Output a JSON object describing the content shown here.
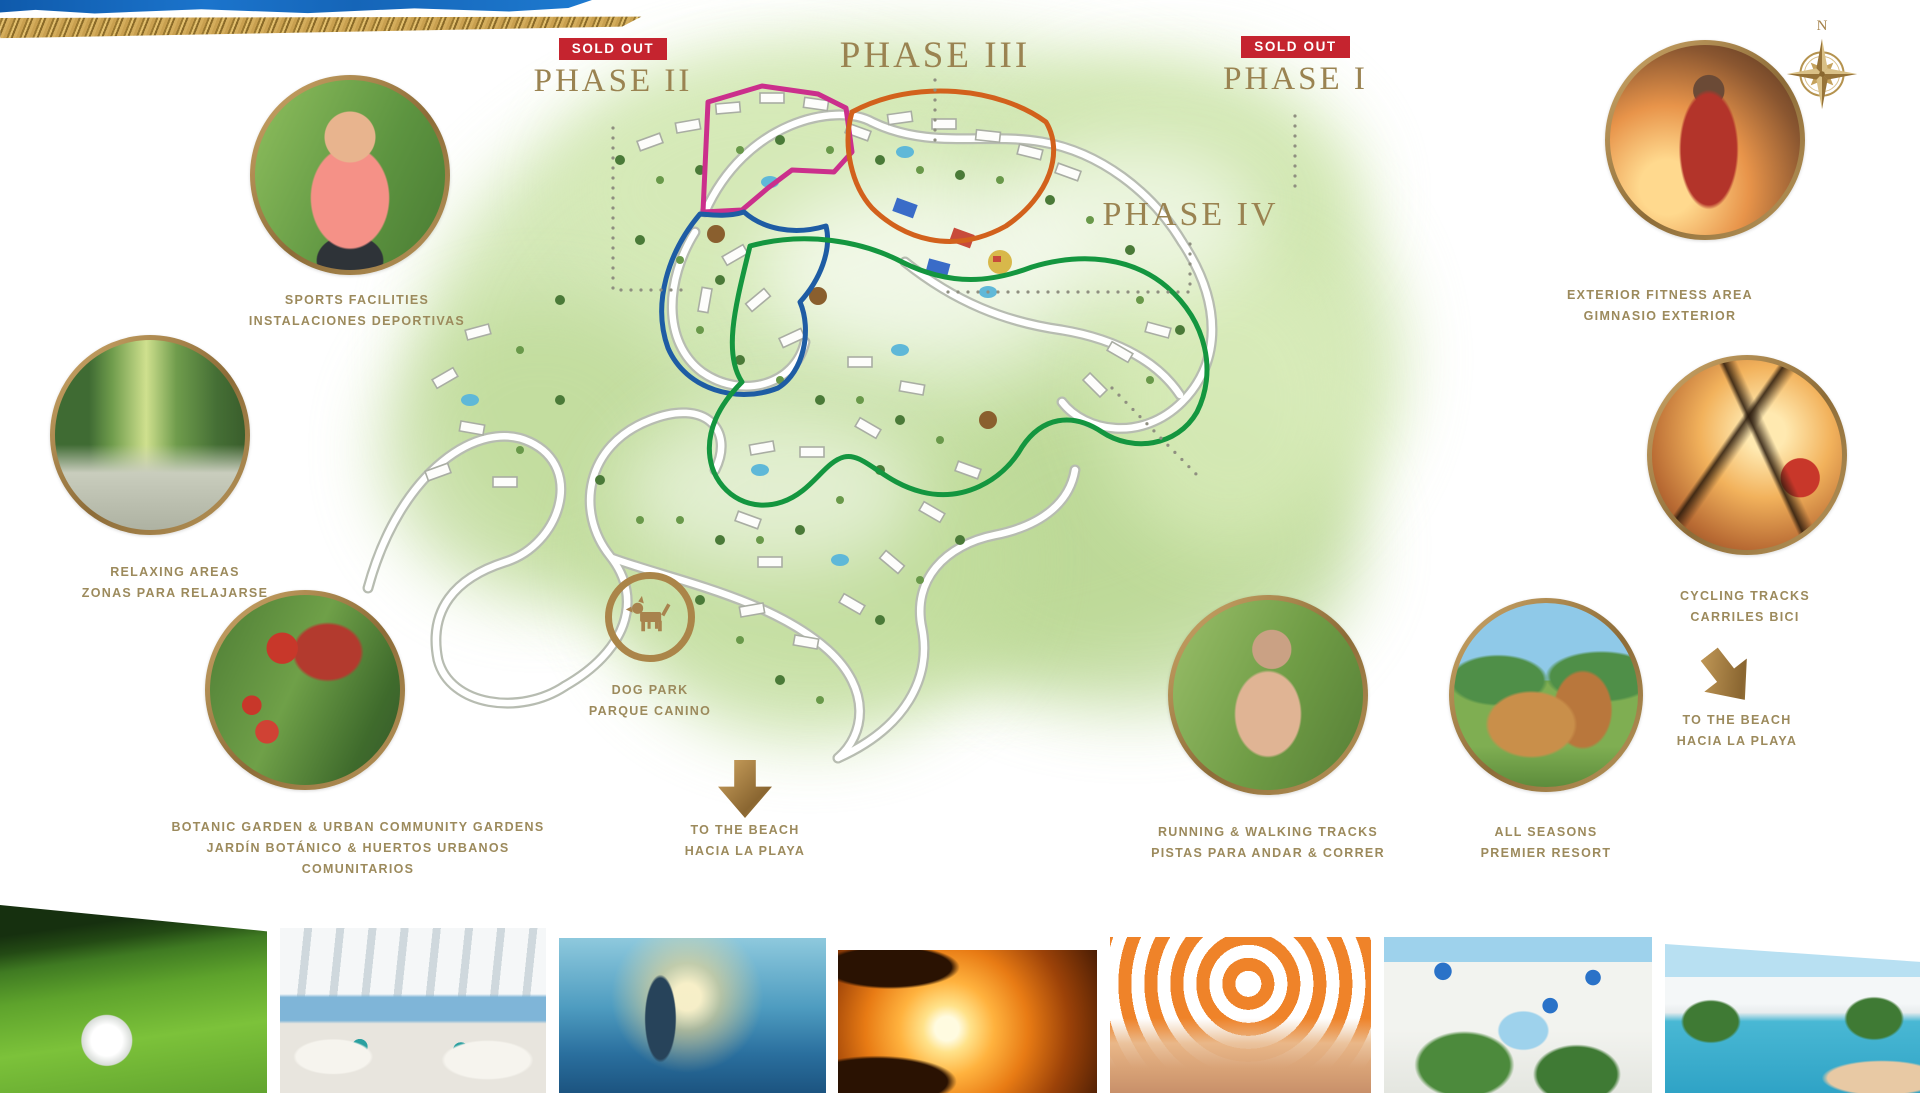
{
  "sold_out_label": "SOLD OUT",
  "compass": {
    "north_label": "N"
  },
  "phases": {
    "p1": {
      "name": "PHASE I",
      "sold_out": true,
      "outline_color": "#d2611c"
    },
    "p2": {
      "name": "PHASE II",
      "sold_out": true,
      "outline_color": "#1e5ca4"
    },
    "p3": {
      "name": "PHASE III",
      "sold_out": false,
      "outline_color": "#cb2f8c"
    },
    "p4": {
      "name": "PHASE IV",
      "sold_out": false,
      "outline_color": "#14963f"
    }
  },
  "callouts": {
    "sports": {
      "lines": [
        "SPORTS FACILITIES",
        "INSTALACIONES DEPORTIVAS"
      ]
    },
    "relaxing": {
      "lines": [
        "RELAXING AREAS",
        "ZONAS PARA RELAJARSE"
      ]
    },
    "botanic": {
      "lines": [
        "BOTANIC GARDEN & URBAN COMMUNITY GARDENS",
        "JARDÍN BOTÁNICO & HUERTOS URBANOS",
        "COMUNITARIOS"
      ]
    },
    "dog_park": {
      "lines": [
        "DOG PARK",
        "PARQUE CANINO"
      ]
    },
    "beach_center": {
      "lines": [
        "TO THE BEACH",
        "HACIA LA PLAYA"
      ]
    },
    "fitness": {
      "lines": [
        "EXTERIOR FITNESS AREA",
        "GIMNASIO EXTERIOR"
      ]
    },
    "cycling": {
      "lines": [
        "CYCLING TRACKS",
        "CARRILES BICI"
      ]
    },
    "beach_right": {
      "lines": [
        "TO THE BEACH",
        "HACIA LA PLAYA"
      ]
    },
    "all_seasons": {
      "lines": [
        "ALL SEASONS",
        "PREMIER RESORT"
      ]
    },
    "running": {
      "lines": [
        "RUNNING & WALKING TRACKS",
        "PISTAS PARA ANDAR & CORRER"
      ]
    }
  },
  "colors": {
    "label_gold": "#9c8a5c",
    "phase_title_gold": "#9a8351",
    "sold_out_red": "#c5242f",
    "ring_gold": "#ab8549",
    "map_green": "#c3dd9e"
  },
  "photo_strip": [
    "golf-ball-on-green",
    "covered-terrace-sea-view",
    "swimmer-splash-sunset",
    "tropical-sunset-palms",
    "woman-striped-sun-hat",
    "white-village-street-flower-pots",
    "resort-pool-gardens"
  ]
}
